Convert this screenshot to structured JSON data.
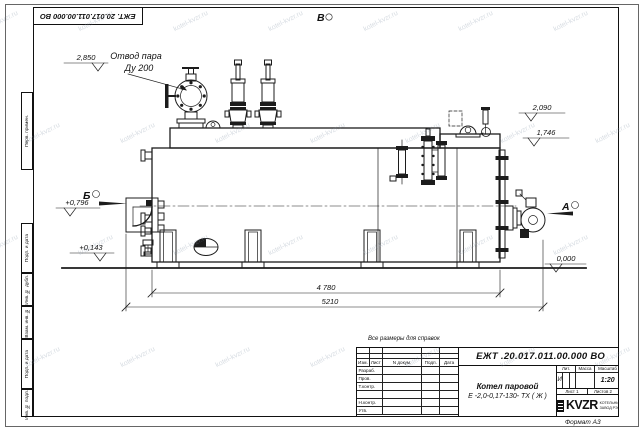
{
  "watermark": {
    "text": "kotel-kvzr.ru"
  },
  "frame": {
    "top_designation": "ЕЖТ. 20.017.011.00.000  ВО",
    "stamp_perv": "Перв. примен.",
    "stamp_podp1": "Подп. и дата",
    "stamp_inv_dubl": "Инв. № дубл.",
    "stamp_vzam": "Взам. инв. №",
    "stamp_podp2": "Подп. и дата",
    "stamp_inv_podl": "Инв. № подл.",
    "format_note": "Формат  А3"
  },
  "drawing": {
    "view_top": "В",
    "view_left": "Б",
    "view_right": "А",
    "callout_line1": "Отвод пара",
    "callout_line2": "Ду 200",
    "elev_steam": "2,850",
    "elev_right_upper": "2,090",
    "elev_right_lower": "1,746",
    "elev_left_upper": "+0,796",
    "elev_left_lower": "+0,143",
    "elev_ground": "0,000",
    "dim_body": "4 780",
    "dim_overall": "5210"
  },
  "note_for_reference": "Все размеры для справок",
  "title_block": {
    "designation": "ЕЖТ .20.017.011.00.000  ВО",
    "product_line1": "Котел паровой",
    "product_line2": "Е -2,0-0,17-130- ТХ ( Ж )",
    "col_izm": "Изм.",
    "col_list": "Лист",
    "col_doc": "N докум.",
    "col_podp": "Подп.",
    "col_data": "Дата",
    "row_razrab": "Разраб.",
    "row_prov": "Пров.",
    "row_tkontr": "Т.контр.",
    "row_nkontr": "Н.контр.",
    "row_utv": "Утв.",
    "lit_header": "Лит.",
    "mass_header": "Масса",
    "scale_header": "Масштаб",
    "lit_value": "И",
    "scale_value": "1:20",
    "sheet_label": "Лист 1",
    "sheets_label": "Листов 2",
    "logo_text": "KVZR",
    "company_line1": "КОТЕЛЬНЫЙ",
    "company_line2": "ЗАВОД РЭП"
  }
}
